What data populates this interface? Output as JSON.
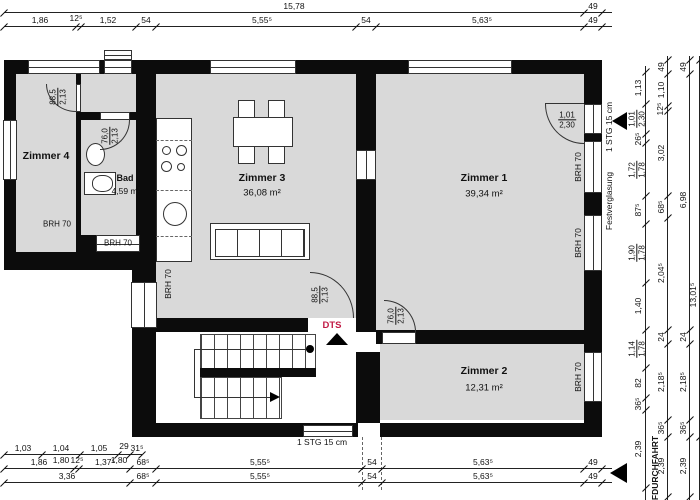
{
  "colors": {
    "wall": "#0c0c0c",
    "room_fill": "#d9d9d9",
    "dts_red": "#c11b45",
    "line": "#222222"
  },
  "rooms": {
    "zimmer1": {
      "name": "Zimmer 1",
      "area": "39,34 m²"
    },
    "zimmer2": {
      "name": "Zimmer 2",
      "area": "12,31 m²"
    },
    "zimmer3": {
      "name": "Zimmer 3",
      "area": "36,08 m²"
    },
    "zimmer4": {
      "name": "Zimmer 4"
    },
    "bad": {
      "name": "Bad",
      "area": "4,59 m²"
    }
  },
  "annotations": {
    "brh70": "BRH 70",
    "dts": "DTS",
    "stg15": "1 STG 15 cm",
    "festverglasung": "Festverglasung",
    "durchfahrt": "FDURCHFAHRT"
  },
  "doors": {
    "entry_z1": {
      "w": "1,01",
      "h": "2,30"
    },
    "z3_dts": {
      "w": "88,5",
      "h": "2,13"
    },
    "z4": {
      "w": "88,5",
      "h": "2,13"
    },
    "bad": {
      "w": "76,0",
      "h": "2,13"
    },
    "z2": {
      "w": "76,0",
      "h": "2,13"
    }
  },
  "dims": {
    "top1": [
      "15,78",
      "49"
    ],
    "top2": [
      "1,86",
      "12⁵",
      "1,52",
      "54",
      "5,55⁵",
      "54",
      "5,63⁵",
      "49"
    ],
    "bottom1": [
      "1,03",
      "1,04",
      "1,05",
      "29",
      "31⁵"
    ],
    "bottom1_sub": [
      "1,80",
      "1,80"
    ],
    "bottom2": [
      "1,86",
      "12⁵",
      "1,37⁵",
      "68⁵",
      "5,55⁵",
      "54",
      "5,63⁵",
      "49"
    ],
    "bottom3": [
      "3,36",
      "68⁵",
      "5,55⁵",
      "54",
      "5,63⁵",
      "49"
    ],
    "rightA": [
      [
        "1,13"
      ],
      [
        "1,01",
        "2,30"
      ],
      [
        "26⁵"
      ],
      [
        "1,72",
        "1,78"
      ],
      [
        "87⁵"
      ],
      [
        "1,90",
        "1,78"
      ],
      [
        "1,40"
      ],
      [
        "1,14",
        "1,78"
      ],
      [
        "82"
      ],
      [
        "36⁵"
      ],
      [
        "2,39"
      ]
    ],
    "rightB": [
      "49",
      "1,10",
      "12⁵",
      "3,02",
      "68⁵",
      "2,04⁵",
      "24",
      "2,18⁵",
      "36⁵",
      "2,39"
    ],
    "rightC": [
      "49",
      "6,98",
      "24",
      "2,18⁵",
      "36⁵",
      "2,39"
    ],
    "rightD": [
      "13,01⁵"
    ]
  }
}
